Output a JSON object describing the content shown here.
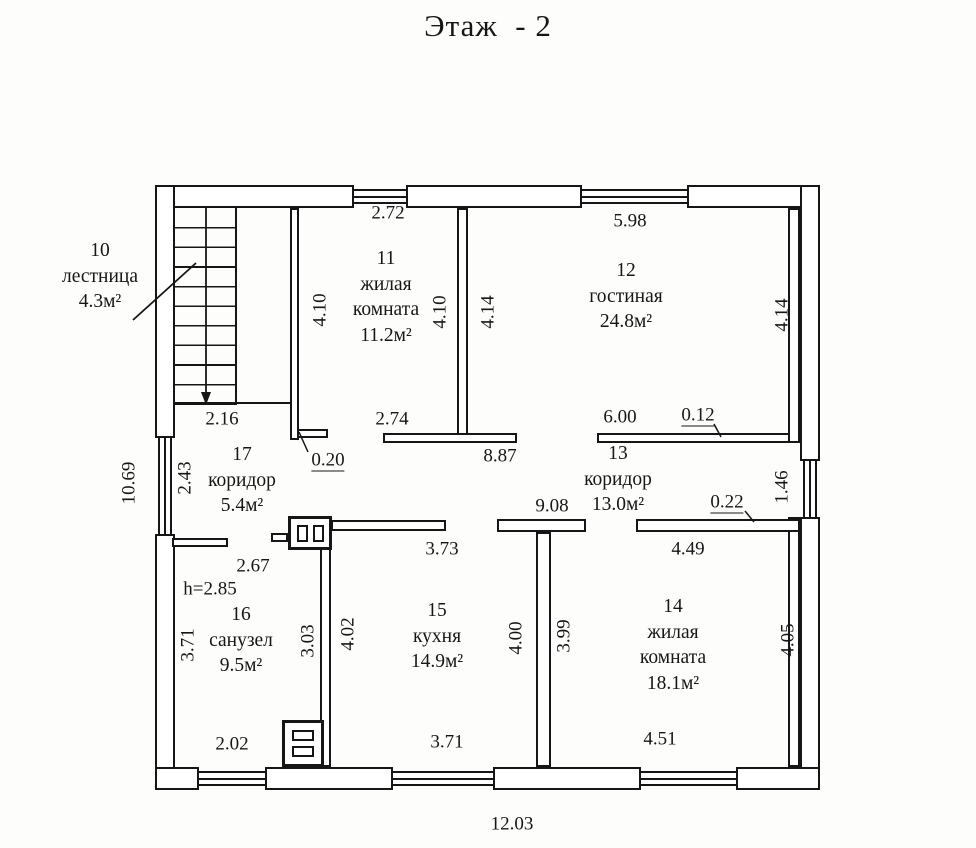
{
  "title": "Этаж  - 2",
  "floor_plan": {
    "rooms": [
      {
        "number": "10",
        "name": "лестница",
        "area": "4.3м²",
        "cx": 100,
        "top": 238
      },
      {
        "number": "11",
        "name": "жилая\nкомната",
        "area": "11.2м²",
        "cx": 386,
        "top": 246
      },
      {
        "number": "12",
        "name": "гостиная",
        "area": "24.8м²",
        "cx": 626,
        "top": 258
      },
      {
        "number": "13",
        "name": "коридор",
        "area": "13.0м²",
        "cx": 618,
        "top": 441
      },
      {
        "number": "14",
        "name": "жилая\nкомната",
        "area": "18.1м²",
        "cx": 673,
        "top": 594
      },
      {
        "number": "15",
        "name": "кухня",
        "area": "14.9м²",
        "cx": 437,
        "top": 598
      },
      {
        "number": "16",
        "name": "санузел",
        "area": "9.5м²",
        "cx": 241,
        "top": 602
      },
      {
        "number": "17",
        "name": "коридор",
        "area": "5.4м²",
        "cx": 242,
        "top": 442
      }
    ],
    "dimensions": [
      {
        "value": "2.72",
        "x": 388,
        "y": 213
      },
      {
        "value": "5.98",
        "x": 630,
        "y": 221
      },
      {
        "value": "2.16",
        "x": 222,
        "y": 419
      },
      {
        "value": "2.74",
        "x": 392,
        "y": 419
      },
      {
        "value": "6.00",
        "x": 620,
        "y": 417
      },
      {
        "value": "0.12",
        "x": 698,
        "y": 416,
        "underline": true
      },
      {
        "value": "8.87",
        "x": 500,
        "y": 456
      },
      {
        "value": "0.20",
        "x": 328,
        "y": 461,
        "underline": true
      },
      {
        "value": "9.08",
        "x": 552,
        "y": 506
      },
      {
        "value": "0.22",
        "x": 727,
        "y": 503,
        "underline": true
      },
      {
        "value": "3.73",
        "x": 442,
        "y": 549
      },
      {
        "value": "4.49",
        "x": 688,
        "y": 549
      },
      {
        "value": "2.67",
        "x": 253,
        "y": 566
      },
      {
        "value": "h=2.85",
        "x": 210,
        "y": 589
      },
      {
        "value": "2.02",
        "x": 232,
        "y": 744
      },
      {
        "value": "3.71",
        "x": 447,
        "y": 742
      },
      {
        "value": "4.51",
        "x": 660,
        "y": 739
      },
      {
        "value": "12.03",
        "x": 512,
        "y": 824
      },
      {
        "value": "4.10",
        "x": 320,
        "y": 310,
        "rotated": true
      },
      {
        "value": "4.10",
        "x": 440,
        "y": 312,
        "rotated": true
      },
      {
        "value": "4.14",
        "x": 488,
        "y": 312,
        "rotated": true
      },
      {
        "value": "4.14",
        "x": 782,
        "y": 315,
        "rotated": true
      },
      {
        "value": "10.69",
        "x": 129,
        "y": 483,
        "rotated": true
      },
      {
        "value": "2.43",
        "x": 185,
        "y": 478,
        "rotated": true
      },
      {
        "value": "1.46",
        "x": 782,
        "y": 487,
        "rotated": true
      },
      {
        "value": "3.71",
        "x": 188,
        "y": 645,
        "rotated": true
      },
      {
        "value": "3.03",
        "x": 308,
        "y": 641,
        "rotated": true
      },
      {
        "value": "4.02",
        "x": 348,
        "y": 634,
        "rotated": true
      },
      {
        "value": "4.00",
        "x": 516,
        "y": 638,
        "rotated": true
      },
      {
        "value": "3.99",
        "x": 564,
        "y": 636,
        "rotated": true
      },
      {
        "value": "4.05",
        "x": 788,
        "y": 640,
        "rotated": true
      }
    ]
  }
}
